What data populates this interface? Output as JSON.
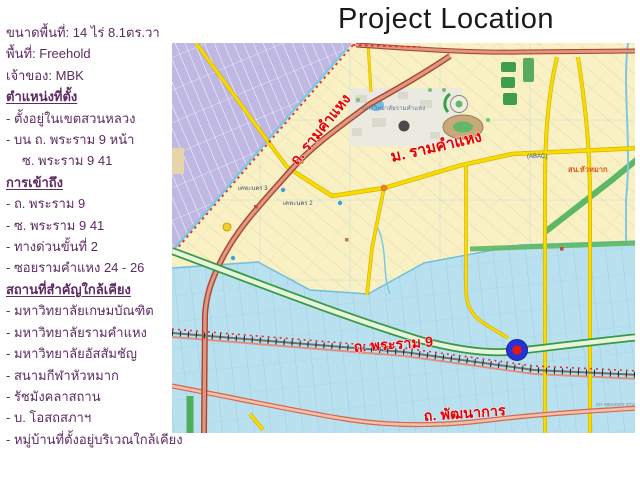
{
  "slide": {
    "title": "Project Location",
    "background": "#ffffff",
    "title_color": "#1a1a1a"
  },
  "info_panel": {
    "text_color": "#5e2a62",
    "lines": [
      {
        "text": "ขนาดพื้นที่: 14 ไร่ 8.1ตร.วา",
        "style": "plain"
      },
      {
        "text": "พื้นที่: Freehold",
        "style": "plain"
      },
      {
        "text": "เจ้าของ: MBK",
        "style": "plain"
      },
      {
        "text": "ตำแหน่งที่ตั้ง",
        "style": "header"
      },
      {
        "text": "- ตั้งอยู่ในเขตสวนหลวง",
        "style": "plain"
      },
      {
        "text": "- บน ถ. พระราม 9 หน้า",
        "style": "plain"
      },
      {
        "text": "ซ. พระราม 9 41",
        "style": "indent"
      },
      {
        "text": "การเข้าถึง",
        "style": "header"
      },
      {
        "text": "- ถ. พระราม 9",
        "style": "plain"
      },
      {
        "text": "- ซ. พระราม 9 41",
        "style": "plain"
      },
      {
        "text": "- ทางด่วนขั้นที่ 2",
        "style": "plain"
      },
      {
        "text": "- ซอยรามคำแหง 24 - 26",
        "style": "plain"
      },
      {
        "text": "สถานที่สำคัญใกล้เคียง",
        "style": "header"
      },
      {
        "text": "- มหาวิทยาลัยเกษมบัณฑิต",
        "style": "plain"
      },
      {
        "text": "- มหาวิทยาลัยรามคำแหง",
        "style": "plain"
      },
      {
        "text": "- มหาวิทยาลัยอัสสัมชัญ",
        "style": "plain"
      },
      {
        "text": "- สนามกีฬาหัวหมาก",
        "style": "plain"
      },
      {
        "text": "- รัชมังคลาสถาน",
        "style": "plain"
      },
      {
        "text": "- บ. โอสถสภาฯ",
        "style": "plain"
      },
      {
        "text": "- หมู่บ้านที่ตั้งอยู่บริเวณใกล้เคียง",
        "style": "plain"
      }
    ]
  },
  "map": {
    "region_colors": {
      "land_cream": "#f9f1c4",
      "district_purple": "#beb8e2",
      "lowland_blue": "#b9e0ef",
      "canal_cyan": "#7cc8e4",
      "park_green": "#5db863"
    },
    "road_colors": {
      "ramkhamhaeng_fill": "#e09880",
      "ramkhamhaeng_casing": "#a84534",
      "motorway_green": "#379a46",
      "minor_yellow": "#f7dc00",
      "phatthanakan_fill": "#f6bfac",
      "railway_gray": "#707070"
    },
    "boundary_color": "#e03030",
    "label_color": "#e60000",
    "marker": {
      "outer_color": "#2333d6",
      "inner_color": "#e01818"
    },
    "labels": {
      "ramkhamhaeng_road": "ถ. รามคำแหง",
      "ramkhamhaeng_univ": "ม. รามคำแหง",
      "rama9_road": "ถ. พระราม 9",
      "phatthanakan_road": "ถ. พัฒนาการ",
      "huamak_police": "สน.หัวหมาก",
      "abac": "(ABAC)",
      "ramkhamhaeng_campus": "มหาวิทยาลัยรามคำแหง",
      "khehanakhon3": "เคหะนคร 3",
      "khehanakhon2": "เคหะนคร 2",
      "memory_studio": "MY MEMORY STUDIO"
    }
  }
}
